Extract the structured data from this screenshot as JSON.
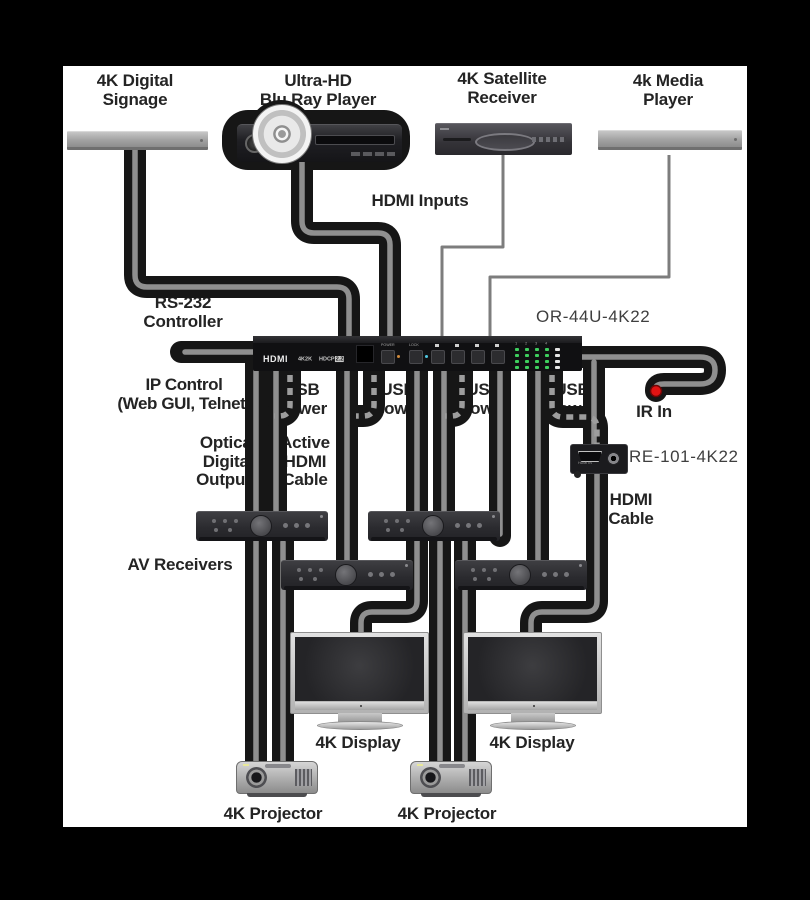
{
  "title": "4K HDMI matrix system diagram",
  "labels": {
    "signage": "4K Digital\nSignage",
    "bluray": "Ultra-HD\nBlu Ray Player",
    "satellite": "4K Satellite\nReceiver",
    "media": "4k Media\nPlayer",
    "hdmi_inputs": "HDMI Inputs",
    "rs232": "RS-232\nController",
    "matrix_model": "OR-44U-4K22",
    "ip_control": "IP Control\n(Web GUI, Telnet)",
    "usb_power": "USB\nPower",
    "ir_in": "IR In",
    "optical_outputs": "Optical\nDigital\nOutputs",
    "active_hdmi": "Active\nHDMI\nCable",
    "extender_model": "RE-101-4K22",
    "hdmi_cable": "HDMI\nCable",
    "av_receivers": "AV Receivers",
    "display": "4K Display",
    "projector": "4K Projector"
  },
  "matrix": {
    "logo": "HDMI",
    "badge_4k2k": "4K2K",
    "badge_hdcp": "HDCP",
    "badge_hdcp_ver": "2.2",
    "power": "POWER",
    "lock": "LOCK",
    "outputs": [
      "1",
      "2",
      "3",
      "4"
    ]
  },
  "extender": {
    "port_label": "HDMI IN"
  },
  "colors": {
    "cable": "#161616",
    "cable_core": "#8f8f8f",
    "usb_core_dashed": "#9d9d9d",
    "thin_line": "#7d7d7d",
    "led_green": "#3ecf5e",
    "ir_red": "#e11313",
    "background": "#000000",
    "canvas": "#ffffff"
  }
}
